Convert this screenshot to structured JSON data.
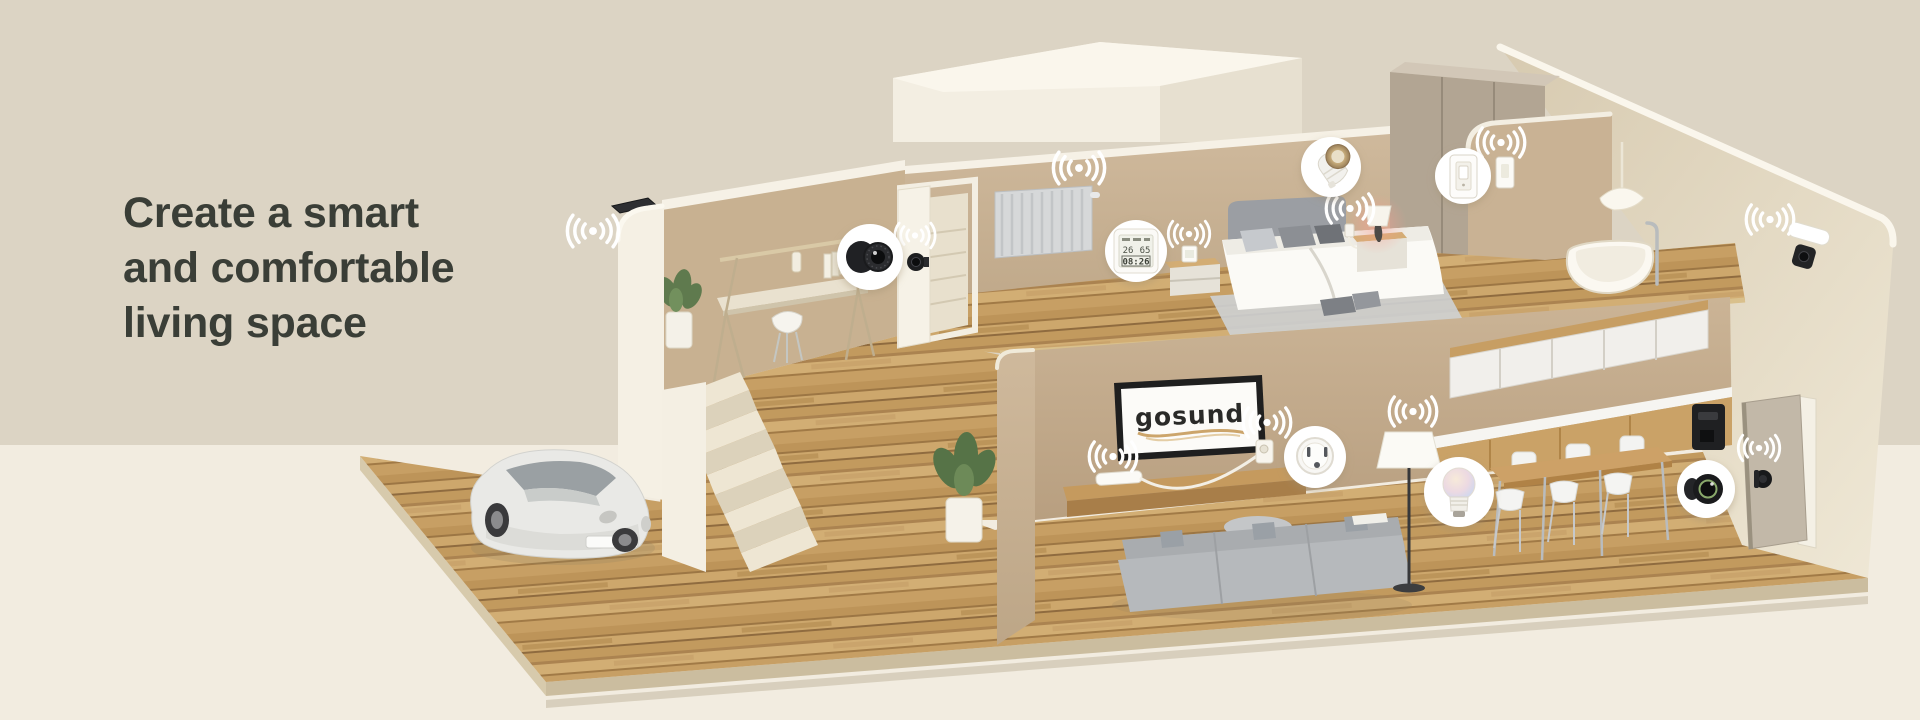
{
  "headline": {
    "lines": [
      "Create a smart",
      "and comfortable",
      "living space"
    ]
  },
  "tv": {
    "brand": "gosund"
  },
  "sensor": {
    "temperature": "26",
    "humidity": "65",
    "time": "08:26"
  },
  "palette": {
    "background_top": "#dcd4c4",
    "background_bottom": "#f2ece0",
    "headline_text": "#3a3e37",
    "wall_tan": "#cbb79a",
    "wall_white": "#f5f0e4",
    "floor_wood": "#c49e63",
    "swoosh_accent": "#c9a063",
    "callout_bg": "#ffffff",
    "device_black": "#1c1d1f"
  },
  "callouts": [
    {
      "icon": "security-camera-icon",
      "device": "indoor security camera"
    },
    {
      "icon": "temperature-humidity-sensor-icon",
      "device": "temperature and humidity sensor"
    },
    {
      "icon": "gu10-smart-bulb-icon",
      "device": "GU10 smart spotlight bulb"
    },
    {
      "icon": "smart-light-switch-icon",
      "device": "smart wall switch"
    },
    {
      "icon": "smart-plug-icon",
      "device": "smart plug"
    },
    {
      "icon": "smart-color-bulb-icon",
      "device": "smart color bulb"
    },
    {
      "icon": "mini-camera-icon",
      "device": "mini smart camera"
    }
  ],
  "scene_icons": {
    "wifi": "wifi-signal-icon",
    "outdoor_camera": "solar-security-camera-icon",
    "floodlight_camera": "floodlight-camera-icon",
    "door_viewer": "door-viewer-camera-icon",
    "door_lock": "smart-door-lock-icon"
  }
}
